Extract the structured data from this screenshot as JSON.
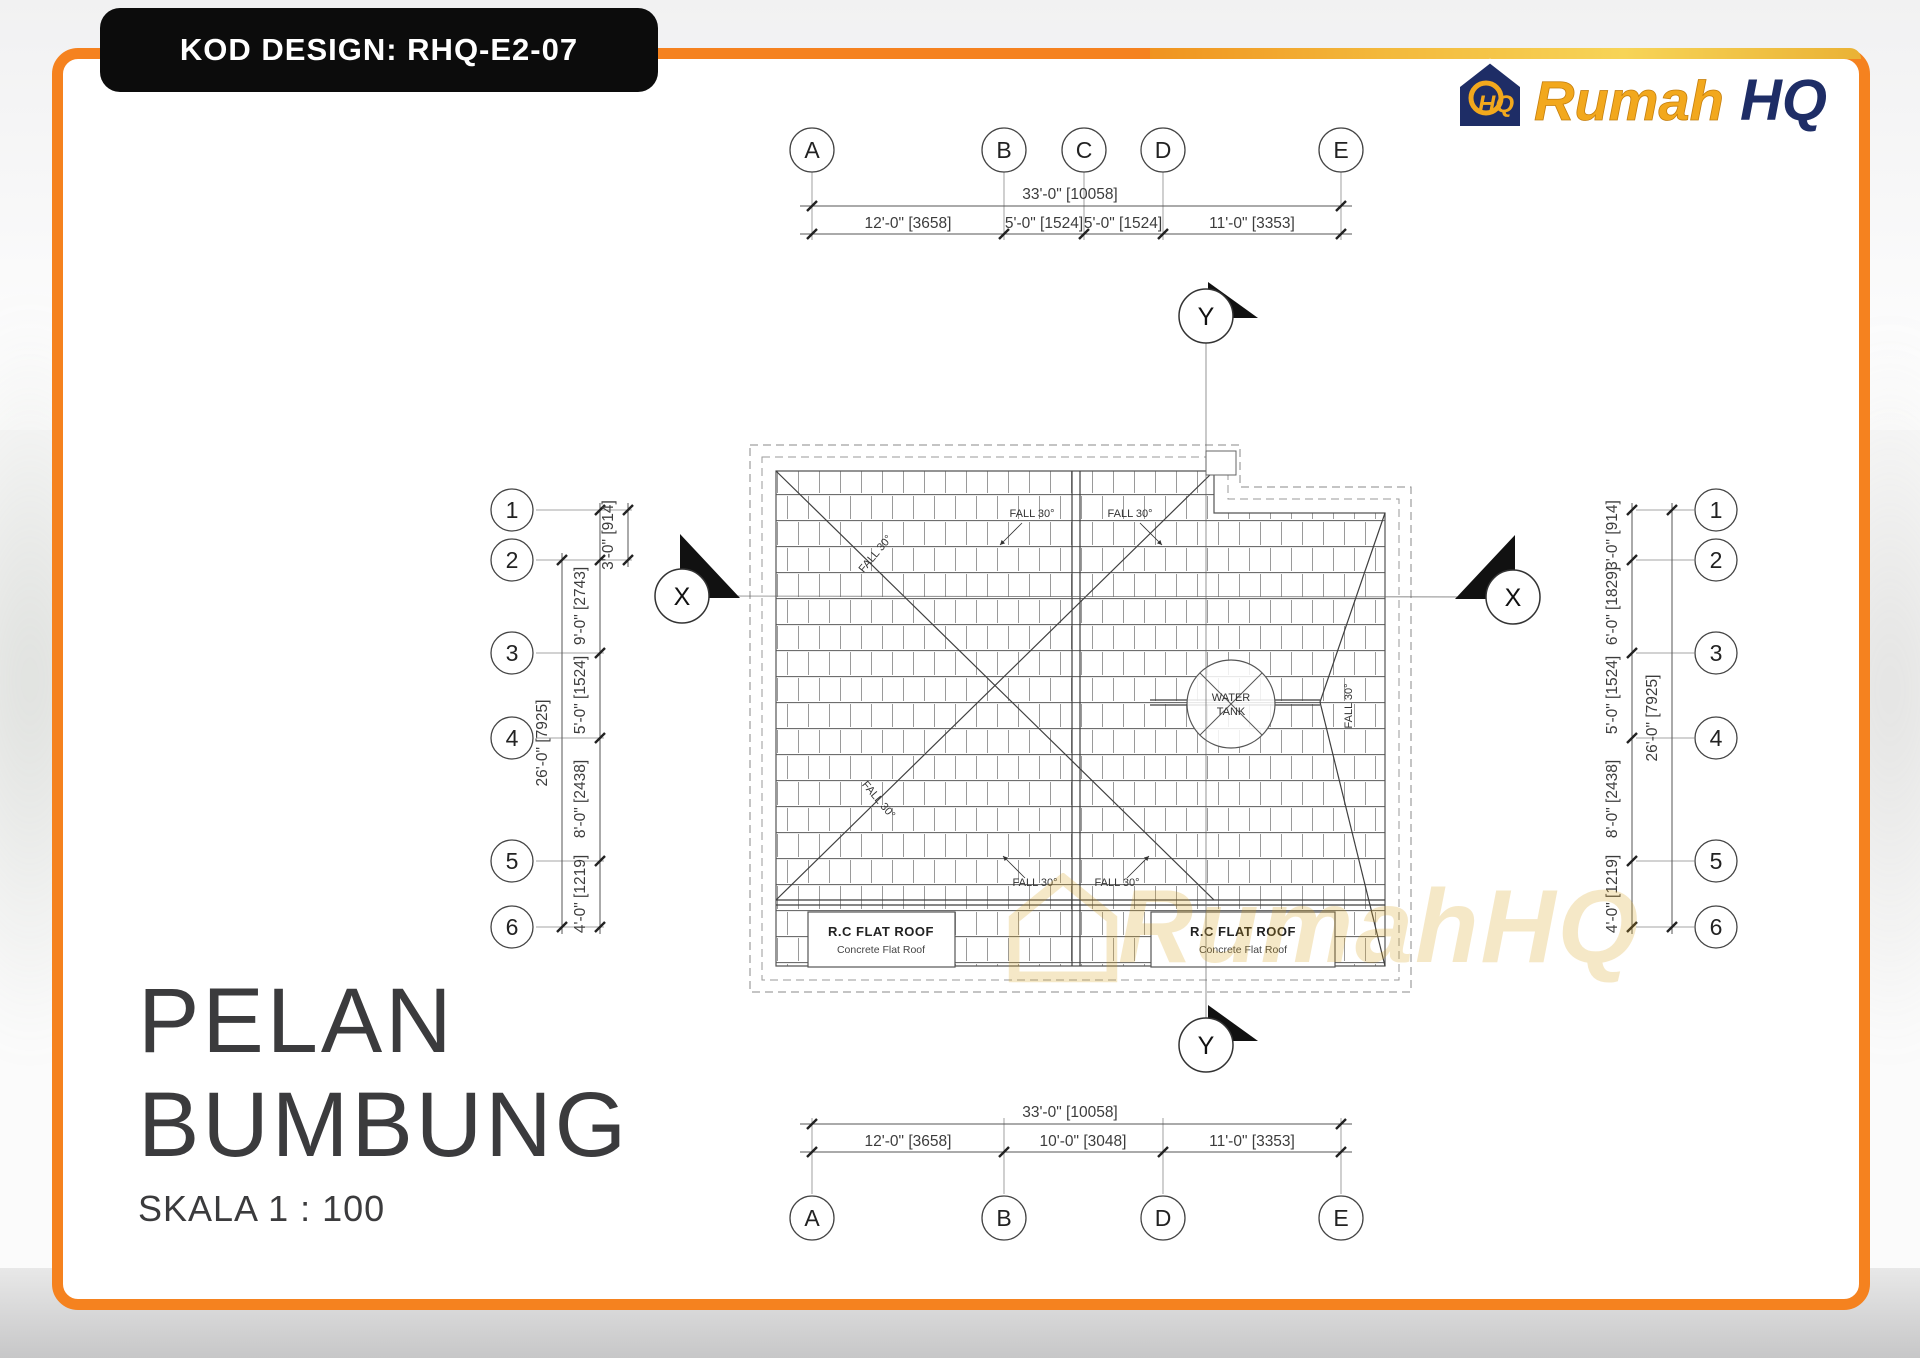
{
  "badge": {
    "text": "KOD DESIGN: RHQ-E2-07"
  },
  "logo": {
    "rumah": "Rumah",
    "hq": "HQ",
    "monogram": "HQ"
  },
  "title": {
    "line1": "PELAN",
    "line2": "BUMBUNG",
    "scale": "SKALA 1 : 100"
  },
  "watermark": {
    "text": "RumahHQ"
  },
  "sections": {
    "x": "X",
    "y": "Y"
  },
  "axes": {
    "top": {
      "bubbles": [
        "A",
        "B",
        "C",
        "D",
        "E"
      ],
      "total": "33'-0\" [10058]",
      "segments": [
        "12'-0\" [3658]",
        "5'-0\" [1524]",
        "5'-0\" [1524]",
        "11'-0\" [3353]"
      ]
    },
    "bottom": {
      "bubbles": [
        "A",
        "B",
        "D",
        "E"
      ],
      "total": "33'-0\" [10058]",
      "segments": [
        "12'-0\" [3658]",
        "10'-0\" [3048]",
        "11'-0\" [3353]"
      ]
    },
    "left": {
      "bubbles": [
        "1",
        "2",
        "3",
        "4",
        "5",
        "6"
      ],
      "total": "26'-0\" [7925]",
      "segments": [
        "3'-0\" [914]",
        "9'-0\" [2743]",
        "5'-0\" [1524]",
        "8'-0\" [2438]",
        "4'-0\" [1219]"
      ]
    },
    "right": {
      "bubbles": [
        "1",
        "2",
        "3",
        "4",
        "5",
        "6"
      ],
      "total": "26'-0\" [7925]",
      "segments": [
        "3'-0\" [914]",
        "6'-0\" [1829]",
        "5'-0\" [1524]",
        "8'-0\" [2438]",
        "4'-0\" [1219]"
      ]
    }
  },
  "plan": {
    "fall_label": "FALL 30°",
    "water_tank_line1": "WATER",
    "water_tank_line2": "TANK",
    "flat_roof_title": "R.C FLAT ROOF",
    "flat_roof_sub": "Concrete Flat Roof"
  },
  "colors": {
    "frame_orange": "#F5821F",
    "gold": "#F2A81D",
    "navy": "#1E2D66",
    "ink": "#3B3B3D",
    "line": "#555555"
  }
}
